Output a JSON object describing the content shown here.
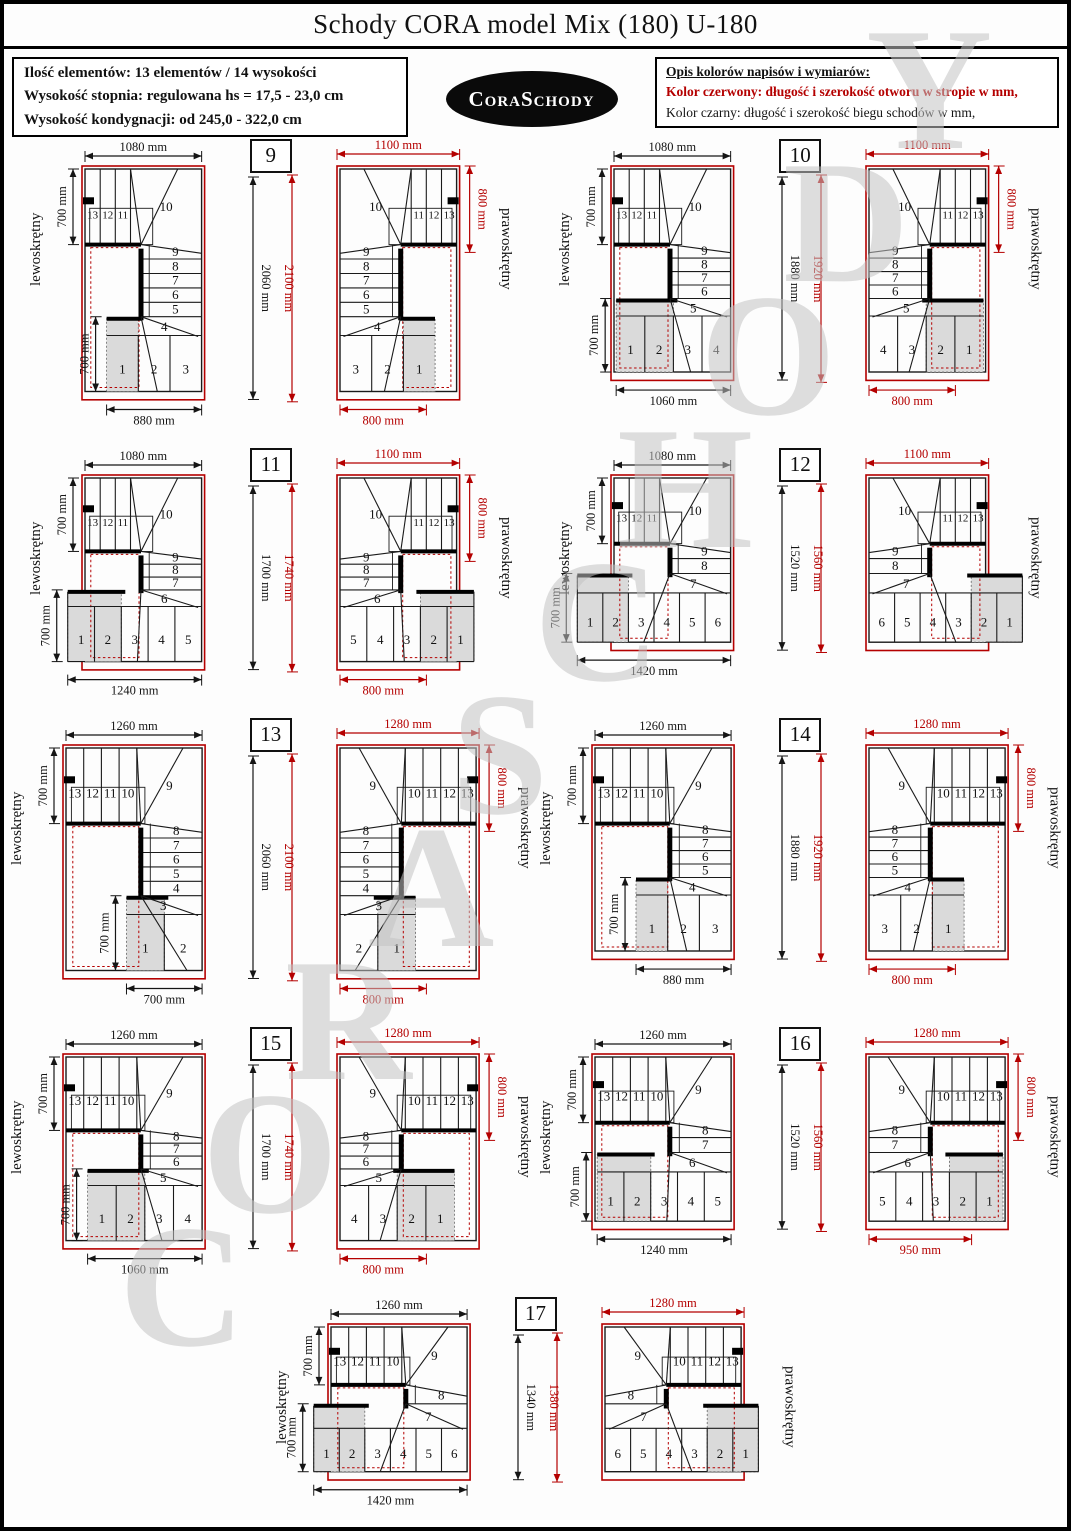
{
  "page": {
    "title": "Schody CORA model Mix (180) U-180",
    "watermark": "CORASCHODY"
  },
  "info_box": {
    "line1": "Ilość elementów: 13 elementów / 14 wysokości",
    "line2": "Wysokość stopnia: regulowana  hs = 17,5 - 23,0 cm",
    "line3": "Wysokość kondygnacji: od 245,0 - 322,0 cm"
  },
  "logo": {
    "text": "CoraSchody"
  },
  "legend_box": {
    "heading": "Opis kolorów napisów i wymiarów:",
    "red_line": "Kolor czerwony: długość i szerokość otworu w stropie w mm,",
    "black_line": "Kolor czarny: długość i szerokość biegu schodów w mm,"
  },
  "labels": {
    "left": "lewoskrętny",
    "right": "prawoskrętny"
  },
  "colors": {
    "red": "#b40000",
    "black": "#151515",
    "shade": "#dadada",
    "watermark": "#c2c2c2"
  },
  "rows": [
    [
      "9",
      "10"
    ],
    [
      "11",
      "12"
    ],
    [
      "13",
      "14"
    ],
    [
      "15",
      "16"
    ],
    [
      "17"
    ]
  ],
  "pairs": [
    {
      "number": "9",
      "dims": {
        "top_black": "1080 mm",
        "top_red": "1100 mm",
        "left_top": "700 mm",
        "left_bottom": "700 mm",
        "vert_black": "2060 mm",
        "vert_red": "2100 mm",
        "right_red": "800 mm",
        "bottom_black": "880 mm",
        "bottom_red": "800 mm"
      },
      "steps": {
        "top": [
          13,
          12,
          11,
          10
        ],
        "mid": [
          9,
          8,
          7,
          6,
          5
        ],
        "turn": 4,
        "bottom": [
          1,
          2,
          3
        ]
      }
    },
    {
      "number": "10",
      "dims": {
        "top_black": "1080 mm",
        "top_red": "1100 mm",
        "left_top": "700 mm",
        "left_bottom": "700 mm",
        "vert_black": "1880 mm",
        "vert_red": "1920 mm",
        "right_red": "800 mm",
        "bottom_black": "1060 mm",
        "bottom_red": "800 mm"
      },
      "steps": {
        "top": [
          13,
          12,
          11,
          10
        ],
        "mid": [
          9,
          8,
          7,
          6
        ],
        "turn": 5,
        "bottom": [
          1,
          2,
          3,
          4
        ]
      }
    },
    {
      "number": "11",
      "dims": {
        "top_black": "1080 mm",
        "top_red": "1100 mm",
        "left_top": "700 mm",
        "left_bottom": "700 mm",
        "vert_black": "1700 mm",
        "vert_red": "1740 mm",
        "right_red": "800 mm",
        "bottom_black": "1240 mm",
        "bottom_red": "800 mm"
      },
      "steps": {
        "top": [
          13,
          12,
          11,
          10
        ],
        "mid": [
          9,
          8,
          7
        ],
        "turn": 6,
        "bottom": [
          1,
          2,
          3,
          4,
          5
        ]
      }
    },
    {
      "number": "12",
      "dims": {
        "top_black": "1080 mm",
        "top_red": "1100 mm",
        "left_top": "700 mm",
        "left_bottom": "700 mm",
        "vert_black": "1520 mm",
        "vert_red": "1560 mm",
        "right_red": null,
        "bottom_black": "1420 mm",
        "bottom_red": null
      },
      "steps": {
        "top": [
          13,
          12,
          11,
          10
        ],
        "mid": [
          9,
          8
        ],
        "turn": 7,
        "bottom": [
          1,
          2,
          3,
          4,
          5,
          6
        ]
      }
    },
    {
      "number": "13",
      "dims": {
        "top_black": "1260 mm",
        "top_red": "1280 mm",
        "left_top": "700 mm",
        "left_bottom": "700 mm",
        "vert_black": "2060 mm",
        "vert_red": "2100 mm",
        "right_red": "800 mm",
        "bottom_black": "700 mm",
        "bottom_red": "800 mm"
      },
      "steps": {
        "top": [
          13,
          12,
          11,
          10,
          9
        ],
        "mid": [
          8,
          7,
          6,
          5,
          4
        ],
        "turn": 3,
        "bottom": [
          1,
          2
        ]
      }
    },
    {
      "number": "14",
      "dims": {
        "top_black": "1260 mm",
        "top_red": "1280 mm",
        "left_top": "700 mm",
        "left_bottom": "700 mm",
        "vert_black": "1880 mm",
        "vert_red": "1920 mm",
        "right_red": "800 mm",
        "bottom_black": "880 mm",
        "bottom_red": "800 mm"
      },
      "steps": {
        "top": [
          13,
          12,
          11,
          10,
          9
        ],
        "mid": [
          8,
          7,
          6,
          5
        ],
        "turn": 4,
        "bottom": [
          1,
          2,
          3
        ]
      }
    },
    {
      "number": "15",
      "dims": {
        "top_black": "1260 mm",
        "top_red": "1280 mm",
        "left_top": "700 mm",
        "left_bottom": "700 mm",
        "vert_black": "1700 mm",
        "vert_red": "1740 mm",
        "right_red": "800 mm",
        "bottom_black": "1060 mm",
        "bottom_red": "800 mm"
      },
      "steps": {
        "top": [
          13,
          12,
          11,
          10,
          9
        ],
        "mid": [
          8,
          7,
          6
        ],
        "turn": 5,
        "bottom": [
          1,
          2,
          3,
          4
        ]
      }
    },
    {
      "number": "16",
      "dims": {
        "top_black": "1260 mm",
        "top_red": "1280 mm",
        "left_top": "700 mm",
        "left_bottom": "700 mm",
        "vert_black": "1520 mm",
        "vert_red": "1560 mm",
        "right_red": "800 mm",
        "bottom_black": "1240 mm",
        "bottom_red": "950 mm"
      },
      "steps": {
        "top": [
          13,
          12,
          11,
          10,
          9
        ],
        "mid": [
          8,
          7
        ],
        "turn": 6,
        "bottom": [
          1,
          2,
          3,
          4,
          5
        ]
      }
    },
    {
      "number": "17",
      "dims": {
        "top_black": "1260 mm",
        "top_red": "1280 mm",
        "left_top": "700 mm",
        "left_bottom": "700 mm",
        "vert_black": "1340 mm",
        "vert_red": "1380 mm",
        "right_red": null,
        "bottom_black": "1420 mm",
        "bottom_red": null
      },
      "steps": {
        "top": [
          13,
          12,
          11,
          10,
          9
        ],
        "mid": [
          8
        ],
        "turn": 7,
        "bottom": [
          1,
          2,
          3,
          4,
          5,
          6
        ]
      }
    }
  ]
}
